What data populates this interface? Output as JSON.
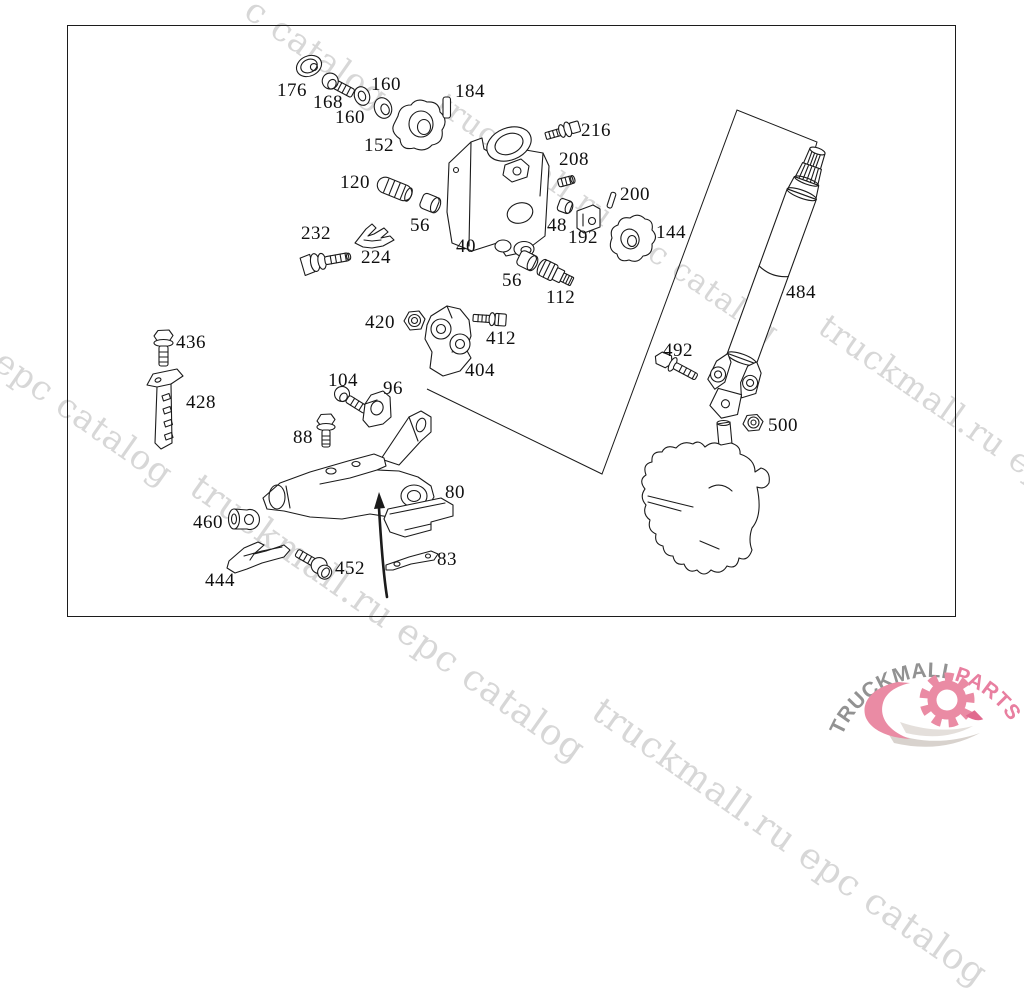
{
  "watermark": {
    "color": "#d7d7d7",
    "angle_deg": 35,
    "instances": [
      {
        "text": "c catalog",
        "x": 260,
        "y": -10,
        "size": 34
      },
      {
        "text": "truckmall.ru epc catalog",
        "x": 450,
        "y": 86,
        "size": 31
      },
      {
        "text": "truckmall.ru epc catalog",
        "x": 834,
        "y": 306,
        "size": 33
      },
      {
        "text": "l epc catalog",
        "x": -10,
        "y": 328,
        "size": 34
      },
      {
        "text": "truckmall.ru epc catalog",
        "x": 206,
        "y": 466,
        "size": 36
      },
      {
        "text": "truckmall.ru epc catalog",
        "x": 608,
        "y": 690,
        "size": 36
      }
    ]
  },
  "diagram": {
    "parts": [
      {
        "label": "176",
        "x": 277,
        "y": 84
      },
      {
        "label": "168",
        "x": 313,
        "y": 96
      },
      {
        "label": "160",
        "x": 371,
        "y": 78
      },
      {
        "label": "160",
        "x": 335,
        "y": 111
      },
      {
        "label": "152",
        "x": 364,
        "y": 139
      },
      {
        "label": "184",
        "x": 455,
        "y": 85
      },
      {
        "label": "216",
        "x": 581,
        "y": 124
      },
      {
        "label": "208",
        "x": 559,
        "y": 153
      },
      {
        "label": "120",
        "x": 340,
        "y": 176
      },
      {
        "label": "56",
        "x": 410,
        "y": 219
      },
      {
        "label": "40",
        "x": 456,
        "y": 240
      },
      {
        "label": "48",
        "x": 547,
        "y": 219
      },
      {
        "label": "192",
        "x": 568,
        "y": 231
      },
      {
        "label": "200",
        "x": 620,
        "y": 188
      },
      {
        "label": "144",
        "x": 656,
        "y": 226
      },
      {
        "label": "232",
        "x": 301,
        "y": 227
      },
      {
        "label": "224",
        "x": 361,
        "y": 251
      },
      {
        "label": "56",
        "x": 502,
        "y": 274
      },
      {
        "label": "112",
        "x": 546,
        "y": 291
      },
      {
        "label": "420",
        "x": 365,
        "y": 316
      },
      {
        "label": "412",
        "x": 486,
        "y": 332
      },
      {
        "label": "404",
        "x": 465,
        "y": 364
      },
      {
        "label": "436",
        "x": 176,
        "y": 336
      },
      {
        "label": "428",
        "x": 186,
        "y": 396
      },
      {
        "label": "104",
        "x": 328,
        "y": 374
      },
      {
        "label": "96",
        "x": 383,
        "y": 382
      },
      {
        "label": "88",
        "x": 293,
        "y": 431
      },
      {
        "label": "80",
        "x": 445,
        "y": 486
      },
      {
        "label": "460",
        "x": 193,
        "y": 516
      },
      {
        "label": "444",
        "x": 205,
        "y": 574
      },
      {
        "label": "452",
        "x": 335,
        "y": 562
      },
      {
        "label": "83",
        "x": 437,
        "y": 553
      },
      {
        "label": "484",
        "x": 786,
        "y": 286
      },
      {
        "label": "492",
        "x": 663,
        "y": 344
      },
      {
        "label": "500",
        "x": 768,
        "y": 419
      }
    ]
  },
  "logo": {
    "brand_left": "TRUCKMALL",
    "brand_right": "PARTS",
    "color_left": "#929292",
    "color_right": "#e87fa0",
    "gear_color": "#ea8ba4",
    "swoosh_color": "#d8d2cd"
  }
}
